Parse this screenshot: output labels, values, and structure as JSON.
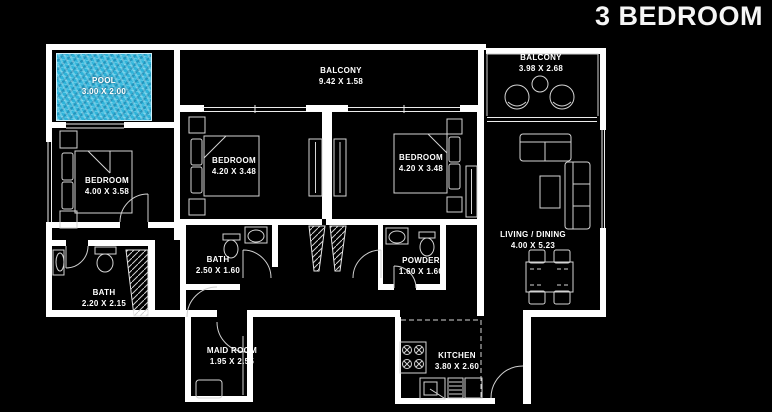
{
  "title": "3 BEDROOM",
  "rooms": {
    "pool": {
      "name": "POOL",
      "dims": "3.00 X 2.00"
    },
    "balcony_top": {
      "name": "BALCONY",
      "dims": "9.42 X 1.58"
    },
    "balcony_right": {
      "name": "BALCONY",
      "dims": "3.98 X 2.68"
    },
    "bedroom_left": {
      "name": "BEDROOM",
      "dims": "4.00 X 3.58"
    },
    "bedroom_mid": {
      "name": "BEDROOM",
      "dims": "4.20 X 3.48"
    },
    "bedroom_right": {
      "name": "BEDROOM",
      "dims": "4.20 X 3.48"
    },
    "living": {
      "name": "LIVING / DINING",
      "dims": "4.00 X 5.23"
    },
    "bath_mid": {
      "name": "BATH",
      "dims": "2.50 X 1.60"
    },
    "powder": {
      "name": "POWDER",
      "dims": "1.60 X 1.60"
    },
    "bath_left": {
      "name": "BATH",
      "dims": "2.20 X 2.15"
    },
    "maid": {
      "name": "MAID ROOM",
      "dims": "1.95 X 2.55"
    },
    "kitchen": {
      "name": "KITCHEN",
      "dims": "3.80 X 2.60"
    }
  },
  "colors": {
    "background": "#000000",
    "wall": "#ffffff",
    "furniture_line": "#d4d4d4",
    "pool_water": "#2fb3d9",
    "text": "#ffffff"
  }
}
